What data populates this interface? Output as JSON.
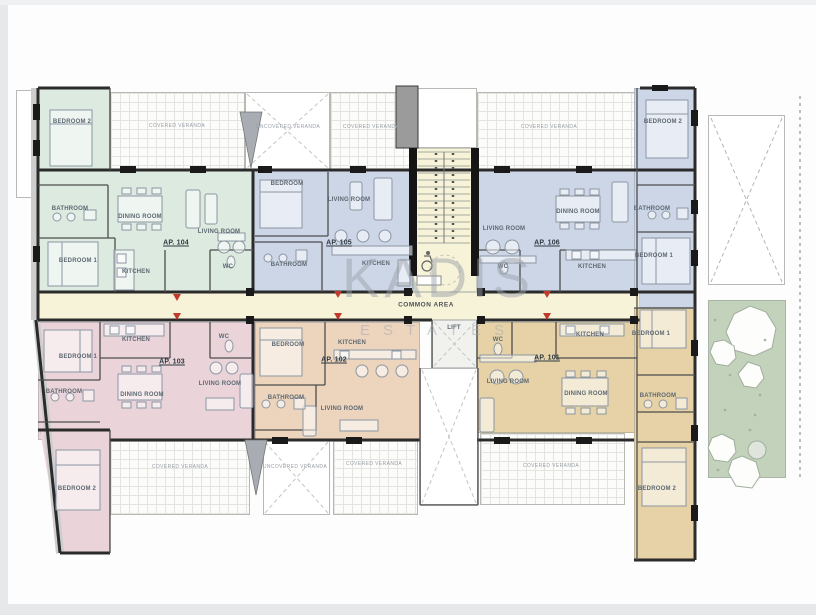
{
  "watermark": {
    "brand": "KADIS",
    "sub": "ESTATES"
  },
  "palette": {
    "ap104_green": "#dceadf",
    "ap105_ap106_blue": "#ccd6e6",
    "ap103_pink": "#ead4d9",
    "ap102_orange": "#ecd4bd",
    "ap101_tan": "#e6d2a6",
    "common_area_yellow": "#f7f3d8",
    "garden_green": "#c3d2bb",
    "entrance_arrow_red": "#c0392b",
    "wall_black": "#1a1a1a"
  },
  "apartments": [
    {
      "id": "AP. 101",
      "color_key": "ap101_tan"
    },
    {
      "id": "AP. 102",
      "color_key": "ap102_orange"
    },
    {
      "id": "AP. 103",
      "color_key": "ap103_pink"
    },
    {
      "id": "AP. 104",
      "color_key": "ap104_green"
    },
    {
      "id": "AP. 105",
      "color_key": "ap105_ap106_blue"
    },
    {
      "id": "AP. 106",
      "color_key": "ap105_ap106_blue"
    }
  ],
  "room_labels": [
    {
      "n": "ap104-bedroom2",
      "t": "BEDROOM 2",
      "x": 72,
      "y": 122,
      "c": "room"
    },
    {
      "n": "ap104-covered-veranda",
      "t": "COVERED VERANDA",
      "x": 177,
      "y": 126,
      "c": "ver"
    },
    {
      "n": "ap105-uncovered-veranda",
      "t": "UNCOVERED VERANDA",
      "x": 288,
      "y": 127,
      "c": "ver"
    },
    {
      "n": "ap105-covered-veranda",
      "t": "COVERED VERANDA",
      "x": 371,
      "y": 127,
      "c": "ver"
    },
    {
      "n": "ap106-covered-veranda",
      "t": "COVERED VERANDA",
      "x": 549,
      "y": 127,
      "c": "ver"
    },
    {
      "n": "ap106-bedroom2",
      "t": "BEDROOM 2",
      "x": 663,
      "y": 122,
      "c": "room"
    },
    {
      "n": "ap104-bathroom",
      "t": "BATHROOM",
      "x": 70,
      "y": 209,
      "c": "room"
    },
    {
      "n": "ap104-dining-room",
      "t": "DINING ROOM",
      "x": 140,
      "y": 217,
      "c": "room"
    },
    {
      "n": "ap104-living-room",
      "t": "LIVING ROOM",
      "x": 219,
      "y": 232,
      "c": "room"
    },
    {
      "n": "ap104-label",
      "t": "AP. 104",
      "x": 176,
      "y": 243,
      "c": "ap"
    },
    {
      "n": "ap104-bedroom1",
      "t": "BEDROOM 1",
      "x": 78,
      "y": 261,
      "c": "room"
    },
    {
      "n": "ap104-kitchen",
      "t": "KITCHEN",
      "x": 136,
      "y": 272,
      "c": "room"
    },
    {
      "n": "ap104-wc",
      "t": "WC",
      "x": 228,
      "y": 267,
      "c": "room"
    },
    {
      "n": "ap105-bedroom",
      "t": "BEDROOM",
      "x": 287,
      "y": 184,
      "c": "room"
    },
    {
      "n": "ap105-living-room",
      "t": "LIVING ROOM",
      "x": 349,
      "y": 200,
      "c": "room"
    },
    {
      "n": "ap105-label",
      "t": "AP. 105",
      "x": 339,
      "y": 243,
      "c": "ap"
    },
    {
      "n": "ap105-bathroom",
      "t": "BATHROOM",
      "x": 289,
      "y": 265,
      "c": "room"
    },
    {
      "n": "ap105-kitchen",
      "t": "KITCHEN",
      "x": 376,
      "y": 264,
      "c": "room"
    },
    {
      "n": "ap106-living-room",
      "t": "LIVING ROOM",
      "x": 504,
      "y": 229,
      "c": "room"
    },
    {
      "n": "ap106-dining-room",
      "t": "DINING ROOM",
      "x": 578,
      "y": 212,
      "c": "room"
    },
    {
      "n": "ap106-label",
      "t": "AP. 106",
      "x": 547,
      "y": 243,
      "c": "ap"
    },
    {
      "n": "ap106-wc",
      "t": "WC",
      "x": 503,
      "y": 267,
      "c": "room"
    },
    {
      "n": "ap106-kitchen",
      "t": "KITCHEN",
      "x": 592,
      "y": 267,
      "c": "room"
    },
    {
      "n": "ap106-bathroom",
      "t": "BATHROOM",
      "x": 652,
      "y": 209,
      "c": "room"
    },
    {
      "n": "ap106-bedroom1",
      "t": "BEDROOM 1",
      "x": 654,
      "y": 256,
      "c": "room"
    },
    {
      "n": "common-area",
      "t": "COMMON AREA",
      "x": 426,
      "y": 305,
      "c": "common"
    },
    {
      "n": "lift",
      "t": "LIFT",
      "x": 454,
      "y": 328,
      "c": "room"
    },
    {
      "n": "ap103-kitchen",
      "t": "KITCHEN",
      "x": 136,
      "y": 340,
      "c": "room"
    },
    {
      "n": "ap103-bedroom1",
      "t": "BEDROOM 1",
      "x": 78,
      "y": 357,
      "c": "room"
    },
    {
      "n": "ap103-wc",
      "t": "WC",
      "x": 224,
      "y": 337,
      "c": "room"
    },
    {
      "n": "ap103-label",
      "t": "AP. 103",
      "x": 172,
      "y": 362,
      "c": "ap"
    },
    {
      "n": "ap103-living-room",
      "t": "LIVING ROOM",
      "x": 220,
      "y": 384,
      "c": "room"
    },
    {
      "n": "ap103-bathroom",
      "t": "BATHROOM",
      "x": 64,
      "y": 392,
      "c": "room"
    },
    {
      "n": "ap103-dining-room",
      "t": "DINING ROOM",
      "x": 142,
      "y": 395,
      "c": "room"
    },
    {
      "n": "ap103-bedroom2",
      "t": "BEDROOM 2",
      "x": 77,
      "y": 489,
      "c": "room"
    },
    {
      "n": "ap103-covered-veranda",
      "t": "COVERED VERANDA",
      "x": 180,
      "y": 467,
      "c": "ver"
    },
    {
      "n": "ap102-bedroom",
      "t": "BEDROOM",
      "x": 288,
      "y": 345,
      "c": "room"
    },
    {
      "n": "ap102-kitchen",
      "t": "KITCHEN",
      "x": 352,
      "y": 343,
      "c": "room"
    },
    {
      "n": "ap102-label",
      "t": "AP. 102",
      "x": 334,
      "y": 360,
      "c": "ap"
    },
    {
      "n": "ap102-bathroom",
      "t": "BATHROOM",
      "x": 286,
      "y": 398,
      "c": "room"
    },
    {
      "n": "ap102-living-room",
      "t": "LIVING ROOM",
      "x": 342,
      "y": 409,
      "c": "room"
    },
    {
      "n": "ap102-uncovered-veranda",
      "t": "UNCOVERED VERANDA",
      "x": 295,
      "y": 467,
      "c": "ver"
    },
    {
      "n": "ap102-covered-veranda",
      "t": "COVERED VERANDA",
      "x": 374,
      "y": 464,
      "c": "ver"
    },
    {
      "n": "ap101-wc",
      "t": "WC",
      "x": 498,
      "y": 340,
      "c": "room"
    },
    {
      "n": "ap101-kitchen",
      "t": "KITCHEN",
      "x": 590,
      "y": 335,
      "c": "room"
    },
    {
      "n": "ap101-bedroom1",
      "t": "BEDROOM 1",
      "x": 651,
      "y": 334,
      "c": "room"
    },
    {
      "n": "ap101-label",
      "t": "AP. 101",
      "x": 547,
      "y": 358,
      "c": "ap"
    },
    {
      "n": "ap101-living-room",
      "t": "LIVING ROOM",
      "x": 508,
      "y": 382,
      "c": "room"
    },
    {
      "n": "ap101-dining-room",
      "t": "DINING ROOM",
      "x": 586,
      "y": 394,
      "c": "room"
    },
    {
      "n": "ap101-bathroom",
      "t": "BATHROOM",
      "x": 658,
      "y": 396,
      "c": "room"
    },
    {
      "n": "ap101-bedroom2",
      "t": "BEDROOM 2",
      "x": 657,
      "y": 489,
      "c": "room"
    },
    {
      "n": "ap101-covered-veranda",
      "t": "COVERED VERANDA",
      "x": 551,
      "y": 466,
      "c": "ver"
    }
  ]
}
